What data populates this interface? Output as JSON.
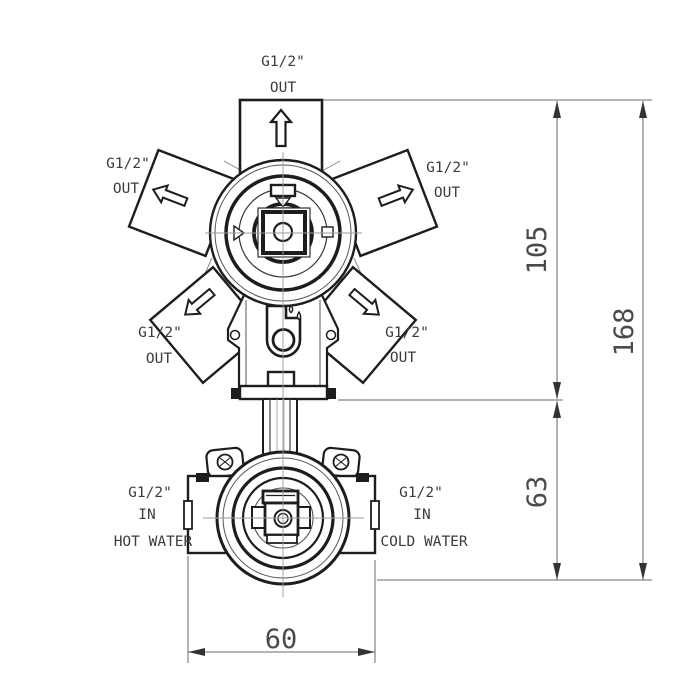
{
  "drawing": {
    "type": "technical-drawing",
    "subject": "concealed shower mixer valve rough-in, front view with ports and dimensions",
    "background": "#ffffff",
    "line_color": "#1d1d1d",
    "dim_line_color": "#6a6a6a",
    "centerline_color": "#9b9b9b",
    "text_color": "#3c3c3c",
    "ports": {
      "top": {
        "size": "G1/2\"",
        "flow": "OUT"
      },
      "upper_left": {
        "size": "G1/2\"",
        "flow": "OUT"
      },
      "upper_right": {
        "size": "G1/2\"",
        "flow": "OUT"
      },
      "lower_left": {
        "size": "G1/2\"",
        "flow": "OUT"
      },
      "lower_right": {
        "size": "G1/2\"",
        "flow": "OUT"
      },
      "inlet_left": {
        "size": "G1/2\"",
        "flow": "IN",
        "medium": "HOT WATER"
      },
      "inlet_right": {
        "size": "G1/2\"",
        "flow": "IN",
        "medium": "COLD WATER"
      }
    },
    "dimensions": {
      "top_to_mid": "105",
      "mid_to_bottom": "63",
      "total_height": "168",
      "body_width": "60"
    }
  }
}
